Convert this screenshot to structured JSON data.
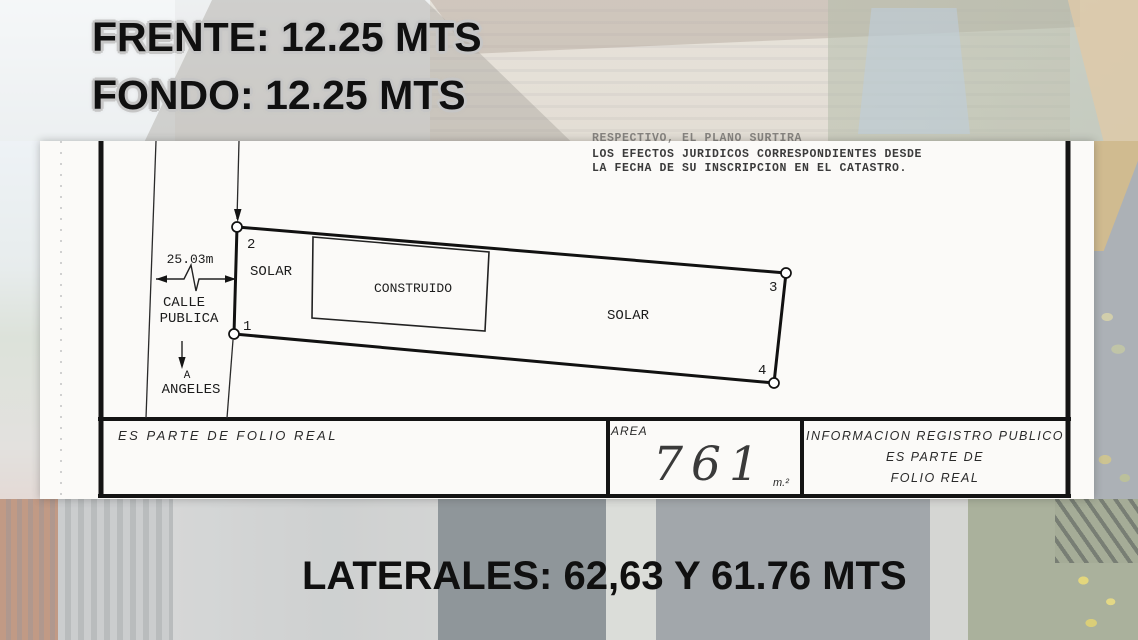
{
  "headlines": {
    "frente": "FRENTE: 12.25 MTS",
    "fondo": "FONDO: 12.25 MTS",
    "laterales": "LATERALES: 62,63 Y 61.76 MTS"
  },
  "plan": {
    "legal_text": {
      "line1": "RESPECTIVO, EL PLANO SURTIRA",
      "line2": "LOS EFECTOS JURIDICOS CORRESPONDIENTES DESDE",
      "line3": "LA FECHA DE SU INSCRIPCION EN EL CATASTRO."
    },
    "street": {
      "width_dimension": "25.03m",
      "name_line1": "CALLE",
      "name_line2": "PUBLICA",
      "direction_marker": "A",
      "direction_destination": "ANGELES"
    },
    "lot": {
      "label_front": "SOLAR",
      "label_back": "SOLAR",
      "building_label": "CONSTRUIDO",
      "corner_1": "1",
      "corner_2": "2",
      "corner_3": "3",
      "corner_4": "4"
    },
    "footer": {
      "folio_note": "ES PARTE DE FOLIO REAL",
      "area_label": "AREA",
      "area_value": "761",
      "area_unit": "m.²",
      "registry_line1": "INFORMACION REGISTRO PUBLICO",
      "registry_line2": "ES PARTE DE",
      "registry_line3": "FOLIO REAL"
    }
  },
  "colors": {
    "headline_ink": "#101010",
    "headline_outline": "#c6c6c6",
    "plan_ink": "#1c1c1c",
    "panel_background": "#fbfaf8"
  }
}
